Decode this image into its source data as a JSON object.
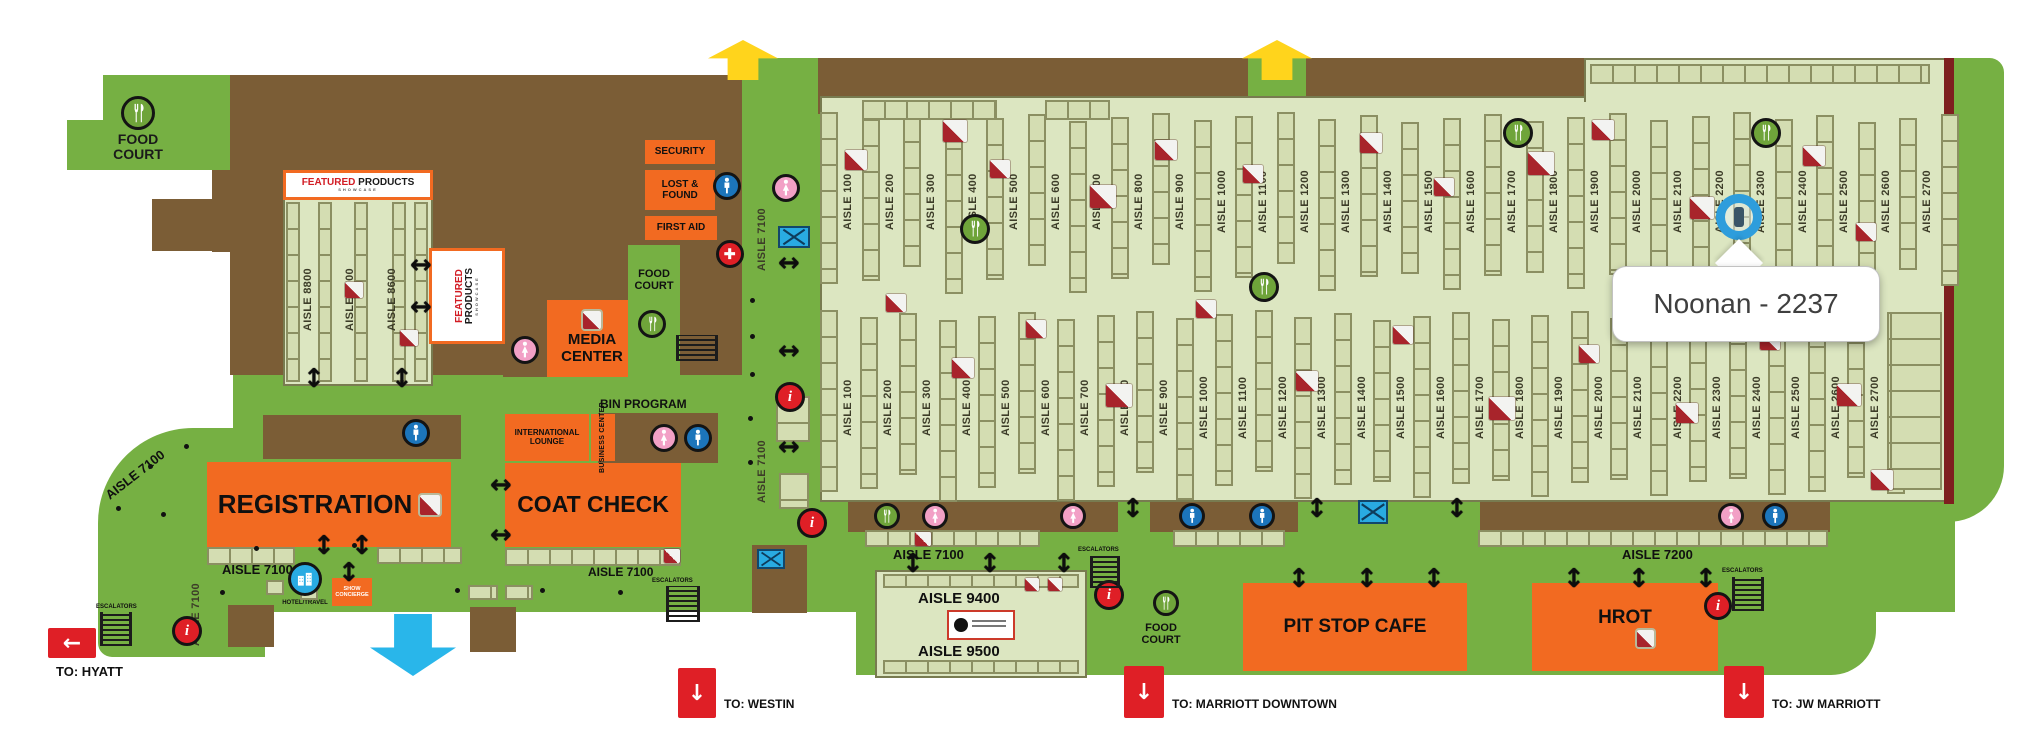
{
  "callout": {
    "text": "Noonan - 2237"
  },
  "facilities": {
    "food_court": "FOOD COURT",
    "security": "SECURITY",
    "lost_found": "LOST & FOUND",
    "first_aid": "FIRST AID",
    "media_center": "MEDIA CENTER",
    "registration": "REGISTRATION",
    "coat_check": "COAT CHECK",
    "international_lounge": "INTERNATIONAL LOUNGE",
    "business_center": "BUSINESS CENTER",
    "bin_program": "BIN PROGRAM",
    "show_concierge": "SHOW CONCIERGE",
    "hotel_travel": "HOTEL/TRAVEL",
    "pit_stop_cafe": "PIT STOP CAFE",
    "hrot": "HROT",
    "escalators": "ESCALATORS"
  },
  "featured": {
    "line1": "FEATURED",
    "line2": "PRODUCTS",
    "line3": "SHOWCASE"
  },
  "exits": {
    "hyatt": "TO: HYATT",
    "westin": "TO: WESTIN",
    "marriott": "TO: MARRIOTT DOWNTOWN",
    "jw": "TO: JW MARRIOTT"
  },
  "aisles": {
    "row1": [
      "AISLE 100",
      "AISLE 200",
      "AISLE 300",
      "AISLE 400",
      "AISLE 500",
      "AISLE 600",
      "AISLE 700",
      "AISLE 800",
      "AISLE 900",
      "AISLE 1000",
      "AISLE 1100",
      "AISLE 1200",
      "AISLE 1300",
      "AISLE 1400",
      "AISLE 1500",
      "AISLE 1600",
      "AISLE 1700",
      "AISLE 1800",
      "AISLE 1900",
      "AISLE 2000",
      "AISLE 2100",
      "AISLE 2200",
      "AISLE 2300",
      "AISLE 2400",
      "AISLE 2500",
      "AISLE 2600",
      "AISLE 2700"
    ],
    "row2": [
      "AISLE 100",
      "AISLE 200",
      "AISLE 300",
      "AISLE 400",
      "AISLE 500",
      "AISLE 600",
      "AISLE 700",
      "AISLE 800",
      "AISLE 900",
      "AISLE 1000",
      "AISLE 1100",
      "AISLE 1200",
      "AISLE 1300",
      "AISLE 1400",
      "AISLE 1500",
      "AISLE 1600",
      "AISLE 1700",
      "AISLE 1800",
      "AISLE 1900",
      "AISLE 2000",
      "AISLE 2100",
      "AISLE 2200",
      "AISLE 2300",
      "AISLE 2400",
      "AISLE 2500",
      "AISLE 2600",
      "AISLE 2700"
    ],
    "west": [
      "AISLE 8800",
      "AISLE 8700",
      "AISLE 8600"
    ],
    "a7100": "AISLE 7100",
    "a7200": "AISLE 7200",
    "a9400": "AISLE 9400",
    "a9500": "AISLE 9500"
  },
  "icons": [
    "food-icon",
    "mens-restroom-icon",
    "womens-restroom-icon",
    "info-icon",
    "first-aid-icon",
    "hotel-travel-icon",
    "escalator-icon",
    "crossed-box-icon",
    "page-curl-marker",
    "up-arrow",
    "down-arrow",
    "left-arrow",
    "two-way-arrow",
    "booth-marker"
  ],
  "colors": {
    "green": "#76b043",
    "brown": "#7b5d36",
    "floor": "#dce6c1",
    "booth": "#d4ddb2",
    "booth_border": "#8b8f62",
    "orange": "#f26a21",
    "red": "#df1f26",
    "yellow": "#ffd41c",
    "cyan": "#29b6ea",
    "mens_blue": "#1c75bb",
    "womens_pink": "#f2a0c6",
    "food_green": "#6fa43a",
    "maroon_edge": "#7e1f1f"
  }
}
